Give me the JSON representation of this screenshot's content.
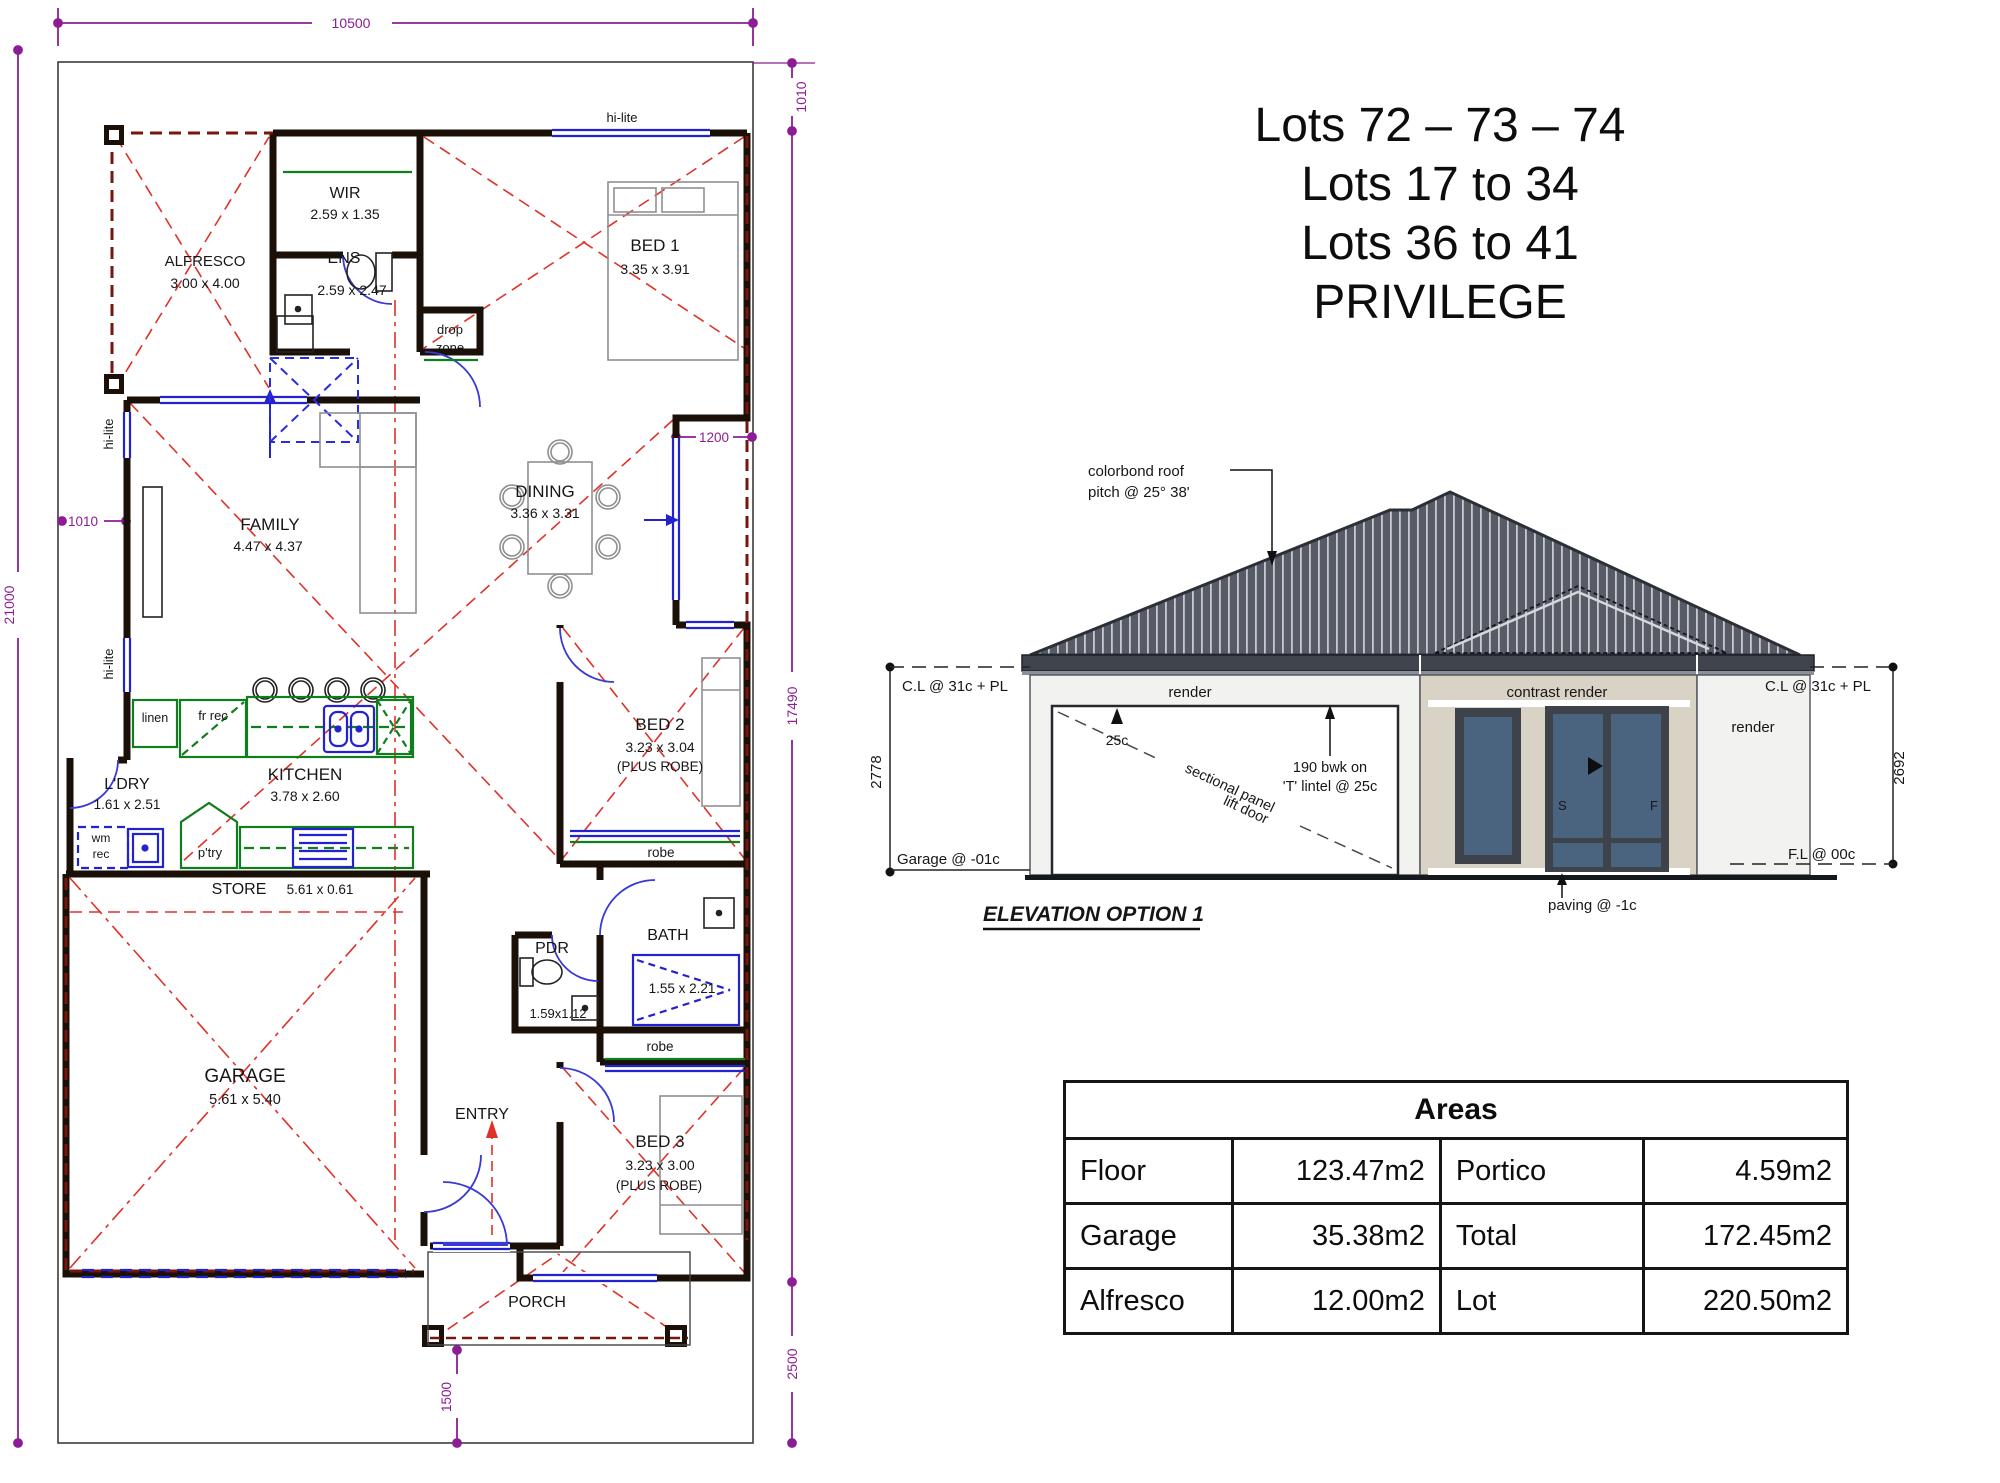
{
  "title_block": {
    "lines": [
      "Lots 72 – 73 – 74",
      "Lots 17 to 34",
      "Lots 36 to 41",
      "PRIVILEGE"
    ]
  },
  "plan": {
    "dims": {
      "top": "10500",
      "left": "21000",
      "left_offset": "1010",
      "right_top": "1010",
      "right_recess": "1200",
      "right_main": "17490",
      "right_bottom": "2500",
      "porch": "1500"
    },
    "labels": {
      "hi_lite": "hi-lite",
      "drop_1": "drop",
      "drop_2": "zone",
      "robe": "robe",
      "linen": "linen",
      "fr_rec": "fr rec",
      "wm_1": "wm",
      "wm_2": "rec",
      "ptry": "p'try"
    },
    "rooms": {
      "alfresco": {
        "name": "ALFRESCO",
        "size": "3.00 x 4.00"
      },
      "wir": {
        "name": "WIR",
        "size": "2.59 x 1.35"
      },
      "ens": {
        "name": "ENS",
        "size": "2.59 x 2.47"
      },
      "bed1": {
        "name": "BED 1",
        "size": "3.35 x 3.91"
      },
      "family": {
        "name": "FAMILY",
        "size": "4.47 x 4.37"
      },
      "dining": {
        "name": "DINING",
        "size": "3.36 x 3.31"
      },
      "kitchen": {
        "name": "KITCHEN",
        "size": "3.78 x 2.60"
      },
      "ldry": {
        "name": "L'DRY",
        "size": "1.61 x 2.51"
      },
      "store": {
        "name": "STORE",
        "size": "5.61 x 0.61"
      },
      "bed2": {
        "name": "BED 2",
        "size": "3.23 x 3.04",
        "extra": "(PLUS ROBE)"
      },
      "bath": {
        "name": "BATH",
        "size": "1.55 x 2.21"
      },
      "pdr": {
        "name": "PDR",
        "size": "1.59x1.12"
      },
      "garage": {
        "name": "GARAGE",
        "size": "5.61 x 5.40"
      },
      "entry": {
        "name": "ENTRY"
      },
      "bed3": {
        "name": "BED 3",
        "size": "3.23 x 3.00",
        "extra": "(PLUS ROBE)"
      },
      "porch": {
        "name": "PORCH"
      }
    }
  },
  "elevation": {
    "title": "ELEVATION OPTION 1",
    "roof_note_1": "colorbond roof",
    "roof_note_2": "pitch @ 25° 38'",
    "left": {
      "cl": "C.L @ 31c + PL",
      "height": "2778",
      "floor": "Garage @ -01c"
    },
    "right": {
      "cl": "C.L @ 31c + PL",
      "height": "2692",
      "floor": "F.L @ 00c",
      "paving": "paving @ -1c"
    },
    "walls": {
      "render_left": "render",
      "contrast": "contrast render",
      "render_right": "render"
    },
    "annotations": {
      "lintel_mark": "25c",
      "door_line_1": "sectional panel",
      "door_line_2": "lift door",
      "bwk_1": "190 bwk on",
      "bwk_2": "'T' lintel @ 25c",
      "s": "S",
      "f": "F"
    }
  },
  "areas_table": {
    "title": "Areas",
    "rows": [
      [
        "Floor",
        "123.47m2",
        "Portico",
        "4.59m2"
      ],
      [
        "Garage",
        "35.38m2",
        "Total",
        "172.45m2"
      ],
      [
        "Alfresco",
        "12.00m2",
        "Lot",
        "220.50m2"
      ]
    ]
  },
  "colors": {
    "wall": "#1a1008",
    "roof_red": "#e03128",
    "window_blue": "#2222cf",
    "joinery_green": "#107d1f",
    "dimension_purple": "#8c1d94",
    "roof_fill": "#565b66",
    "contrast_render": "#d8d3c5"
  }
}
